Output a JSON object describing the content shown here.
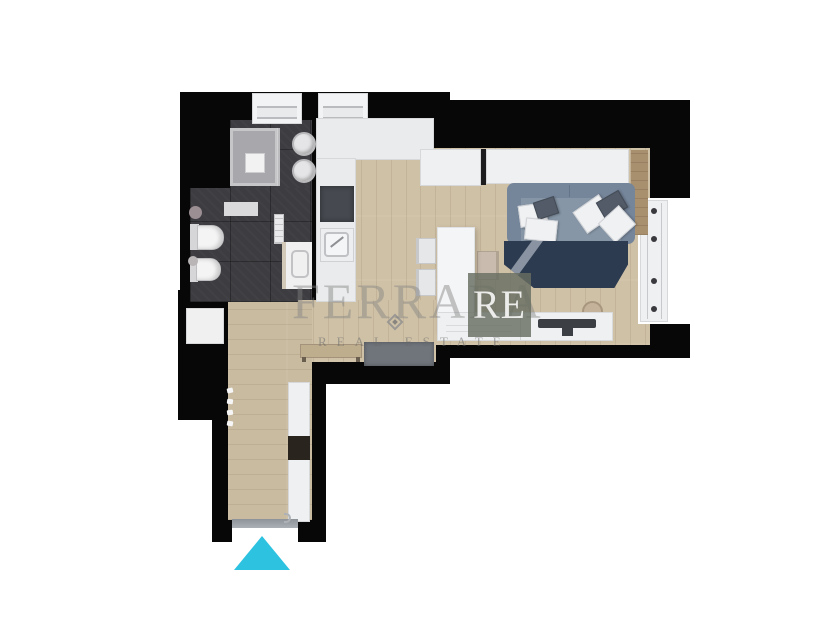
{
  "watermark": {
    "brand_main": "FERRARA",
    "brand_badge": "RE",
    "tagline": "REAL ESTATE"
  },
  "entrance": {
    "direction": "up",
    "arrow_color": "#2cc2e0"
  },
  "palette": {
    "wall": "#070707",
    "bathroom_tile": "#3d3d41",
    "wood_floor": "#cfc1a6",
    "kitchen_counter": "#e9ebec",
    "cooktop": "#464a50",
    "sofa": "#7d8da0",
    "rug": "#2d3b50",
    "accent_cyan": "#2cc2e0"
  }
}
